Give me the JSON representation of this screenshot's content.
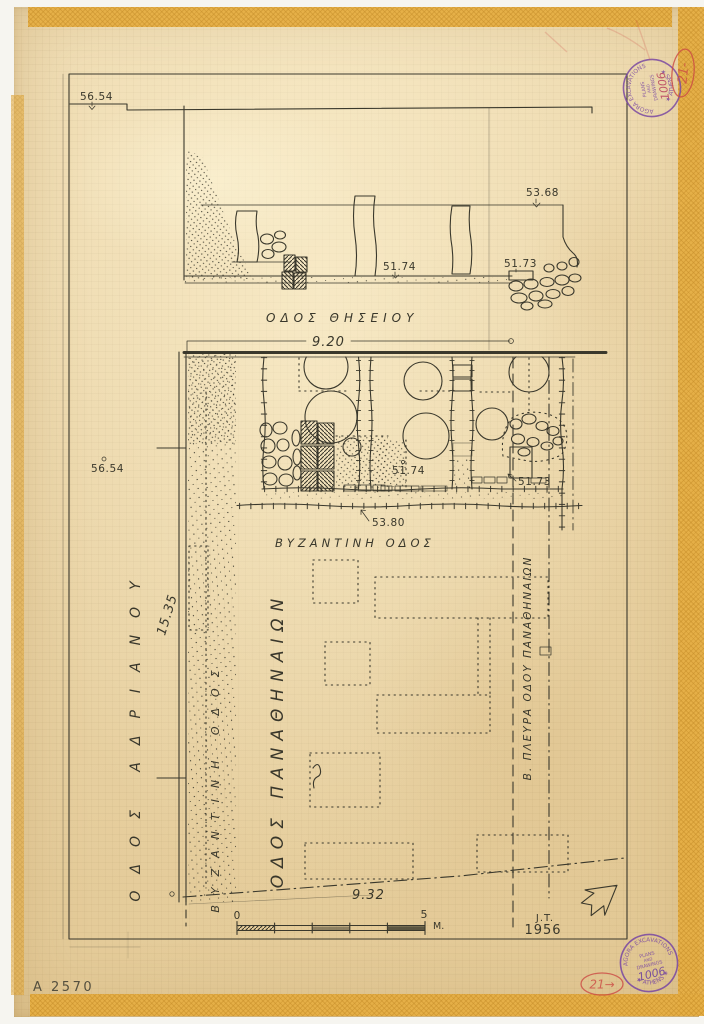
{
  "colors": {
    "ink": "#3a382c",
    "paper": "#ecd7aa",
    "tape": "#e6af45",
    "stamp_purple": "#7b4aa2",
    "annotation_red": "#cc4a44"
  },
  "section": {
    "elev_surface": "56.54",
    "elev_terrace": "53.68",
    "elev_street": "51.74",
    "elev_stones": "51.73",
    "street": "ΟΔΟΣ ΘΗΣΕΙΟΥ"
  },
  "plan": {
    "dim_top": "9.20",
    "dim_bottom": "9.32",
    "dim_left": "15.35",
    "elev_left": "56.54",
    "elev_road": "53.80",
    "elev_room_mid": "51.74",
    "elev_room_right": "51.73",
    "street_adrianou": "ΟΔΟΣ ΑΔΡΙΑΝΟΥ",
    "street_byzantine_vertical": "ΒΥΖΑΝΤΙΝΗ ΟΔΟΣ",
    "street_byzantine_horizontal": "ΒΥΖΑΝΤΙΝΗ ΟΔΟΣ",
    "street_panathenaion": "ΟΔΟΣ ΠΑΝΑΘΗΝΑΙΩΝ",
    "side_panathenaion": "Β. ΠΛΕΥΡΑ ΟΔΟΥ ΠΑΝΑΘΗΝΑΙΩΝ"
  },
  "scale_bar": {
    "zero": "0",
    "five": "5",
    "unit": "M."
  },
  "signature": {
    "initials": "J.T.",
    "year": "1956"
  },
  "catalog_number": "A 2570",
  "stamps": {
    "arc_top": "AGORA EXCAVATIONS",
    "arc_bottom": "★ ATHENS ★",
    "line1": "PLANS",
    "line2": "AND",
    "line3": "DRAWINGS",
    "number": "1006"
  },
  "red_annotations": {
    "top": "21-",
    "bottom": "21→"
  }
}
